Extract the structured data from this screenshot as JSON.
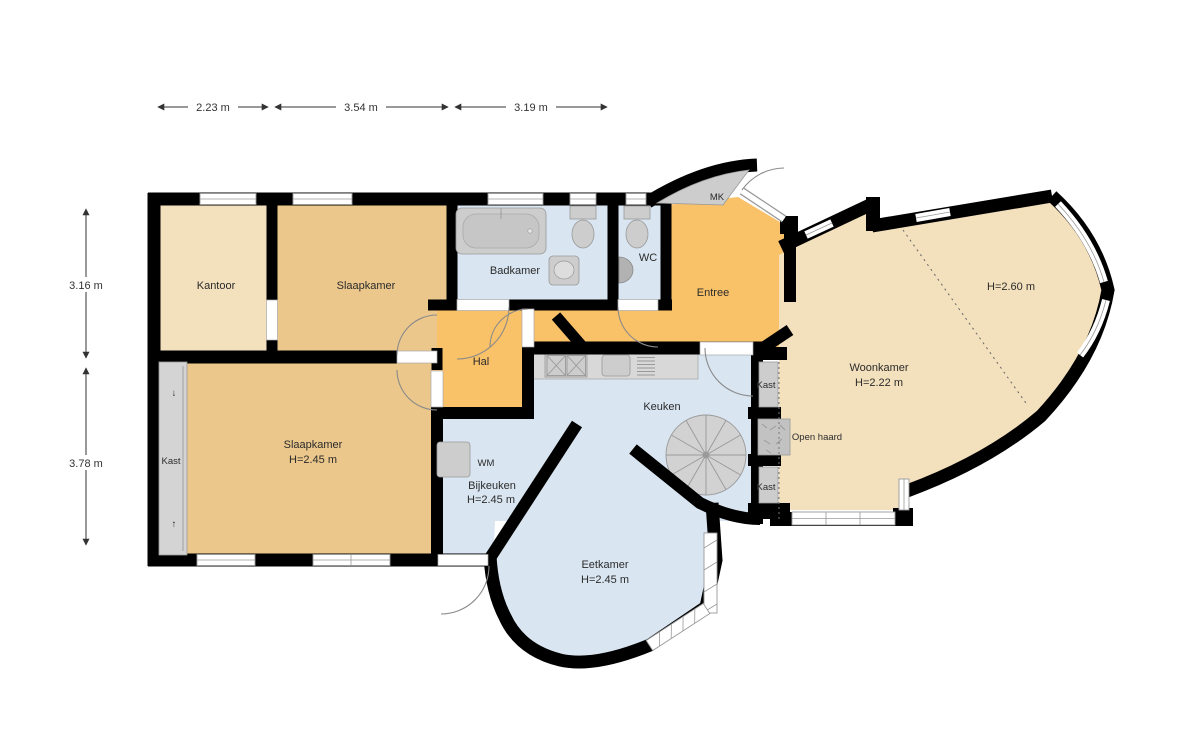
{
  "floorplan": {
    "title": "Floor plan (begane grond)",
    "dimensions_top": [
      {
        "label": "2.23 m"
      },
      {
        "label": "3.54 m"
      },
      {
        "label": "3.19 m"
      }
    ],
    "dimensions_left": [
      {
        "label": "3.16 m"
      },
      {
        "label": "3.78 m"
      }
    ],
    "labels": {
      "kantoor": "Kantoor",
      "slaapkamer_boven": "Slaapkamer",
      "badkamer": "Badkamer",
      "wc": "WC",
      "mk": "MK",
      "entree": "Entree",
      "hal": "Hal",
      "keuken": "Keuken",
      "woonkamer": "Woonkamer",
      "woonkamer_h": "H=2.22 m",
      "woonkamer_h2": "H=2.60 m",
      "slaapkamer_onder": "Slaapkamer",
      "slaapkamer_onder_h": "H=2.45 m",
      "bijkeuken": "Bijkeuken",
      "bijkeuken_h": "H=2.45 m",
      "eetkamer": "Eetkamer",
      "eetkamer_h": "H=2.45 m",
      "kast": "Kast",
      "open_haard": "Open haard",
      "wm": "WM",
      "arrow_down": "↓",
      "arrow_up": "↑"
    },
    "colors": {
      "background": "#ffffff",
      "wall": "#000000",
      "room_tan_light": "#f3e0bd",
      "room_tan": "#ebc78c",
      "room_orange": "#f9c168",
      "room_blue": "#d9e5f1",
      "fixture_gray": "#cdcdcd",
      "fixture_gray_dark": "#b2b2b2",
      "counter_gray": "#d8d8d8"
    }
  }
}
